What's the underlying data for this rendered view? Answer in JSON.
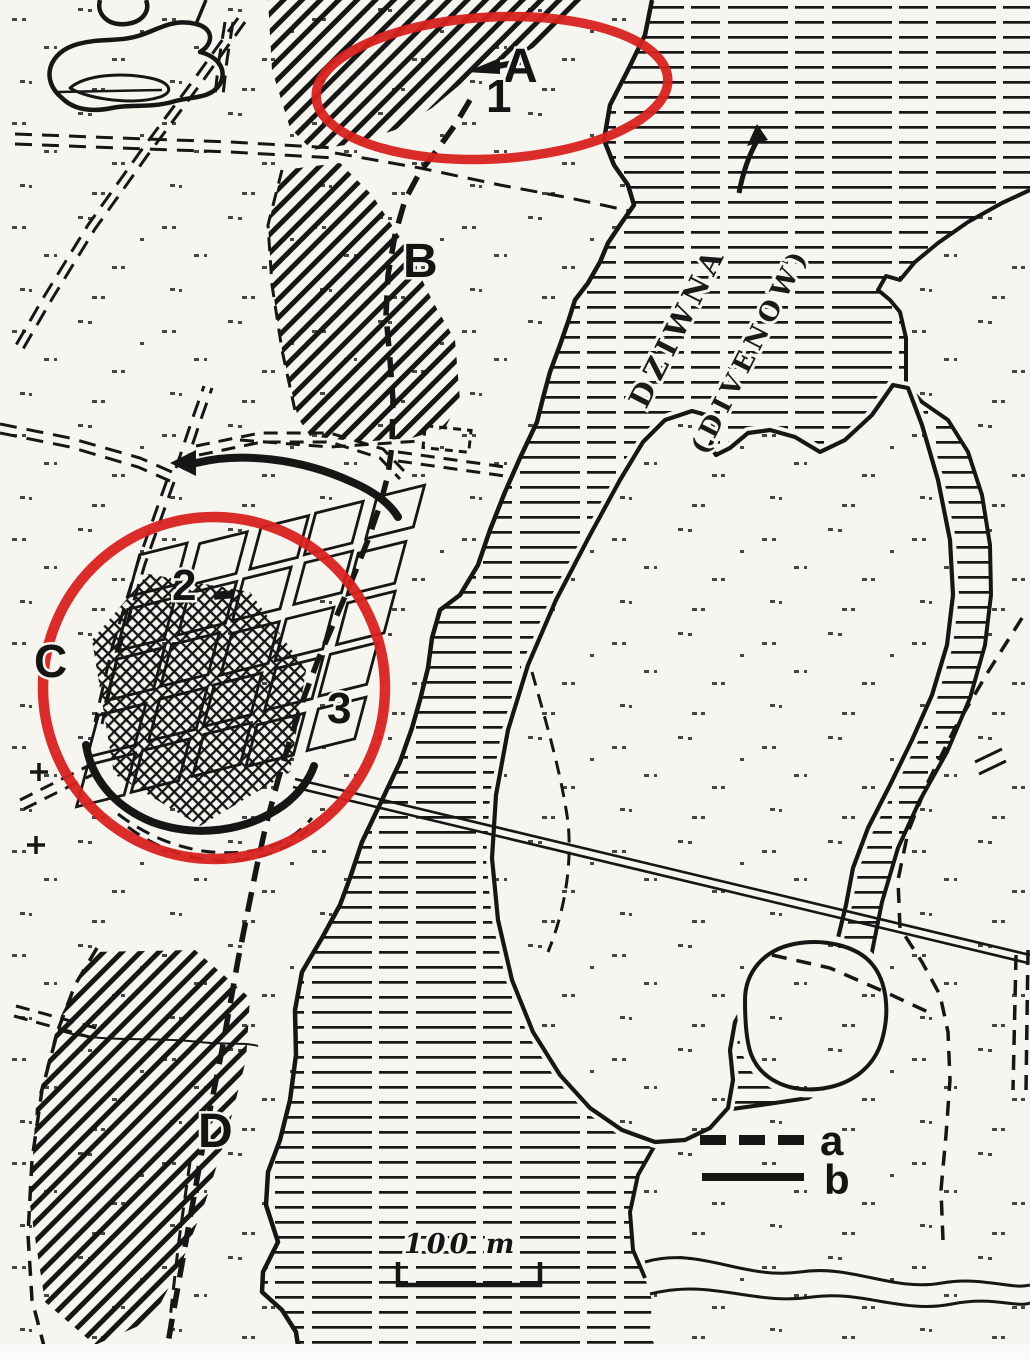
{
  "map": {
    "areas": {
      "a": "A",
      "b": "B",
      "c": "C",
      "d": "D"
    },
    "sites": {
      "s1": "1",
      "s2": "2",
      "s3": "3"
    },
    "river": {
      "name": "DZIWNA",
      "name_alt": "(DIVENOW)"
    },
    "legend": {
      "item_dashed": "a",
      "item_solid": "b"
    },
    "scale_label": "100 m",
    "colors": {
      "highlight": "#d8221f",
      "ink": "#161616",
      "paper": "#f7f5f0"
    }
  }
}
